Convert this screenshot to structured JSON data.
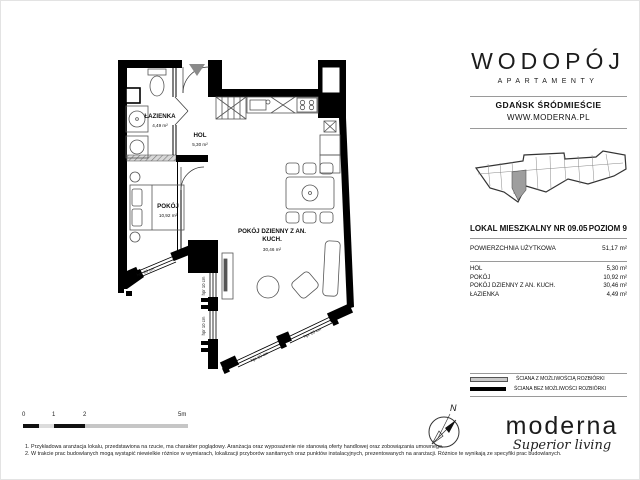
{
  "brand": {
    "name": "WODOPÓJ",
    "subtitle": "APARTAMENTY",
    "location": "GDAŃSK ŚRÓDMIEŚCIE",
    "website": "WWW.MODERNA.PL"
  },
  "unit": {
    "title": "LOKAL MIESZKALNY NR 09.05",
    "level": "POZIOM 9",
    "area_label": "POWIERZCHNIA UŻYTKOWA",
    "area_value": "51,17 m²"
  },
  "rooms": [
    {
      "name": "HOL",
      "area": "5,30 m²"
    },
    {
      "name": "POKÓJ",
      "area": "10,92 m²"
    },
    {
      "name": "POKÓJ DZIENNY Z AN. KUCH.",
      "area": "30,46 m²"
    },
    {
      "name": "ŁAZIENKA",
      "area": "4,49 m²"
    }
  ],
  "plan": {
    "labels": {
      "bathroom": {
        "name": "ŁAZIENKA",
        "area": "4,49 m²"
      },
      "hall": {
        "name": "HOL",
        "area": "5,30 m²"
      },
      "bedroom": {
        "name": "POKÓJ",
        "area": "10,92 m²"
      },
      "living": {
        "name_line1": "POKÓJ DZIENNY Z AN.",
        "name_line2": "KUCH.",
        "area": "30,46 m²"
      }
    },
    "window_sill_label": "hpr 10 cm"
  },
  "legend": [
    {
      "label": "ŚCIANA Z MOŻLIWOŚCIĄ ROZBIÓRKI",
      "style": "gray"
    },
    {
      "label": "ŚCIANA BEZ MOŻLIWOŚCI ROZBIÓRKI",
      "style": "black"
    }
  ],
  "scale_bar": {
    "ticks": [
      "0",
      "1",
      "2",
      "5m"
    ]
  },
  "compass": {
    "north": "N"
  },
  "logo": {
    "name": "moderna",
    "tagline": "Superior living"
  },
  "footnotes": [
    "1.  Przykładowa aranżacja lokalu, przedstawiona na rzucie, ma charakter poglądowy. Aranżacja oraz wyposażenie nie stanowią oferty handlowej oraz zobowiązania umownego.",
    "2.  W trakcie prac budowlanych mogą wystąpić niewielkie różnice w wymiarach, lokalizacji przyborów sanitarnych oraz punktów instalacyjnych, prezentowanych na aranżacji. Różnice te wynikają ze specyfiki prac budowlanych."
  ],
  "colors": {
    "wall": "#000000",
    "demolishable": "#bdbdbd",
    "highlight_unit": "#9e9e9e"
  }
}
